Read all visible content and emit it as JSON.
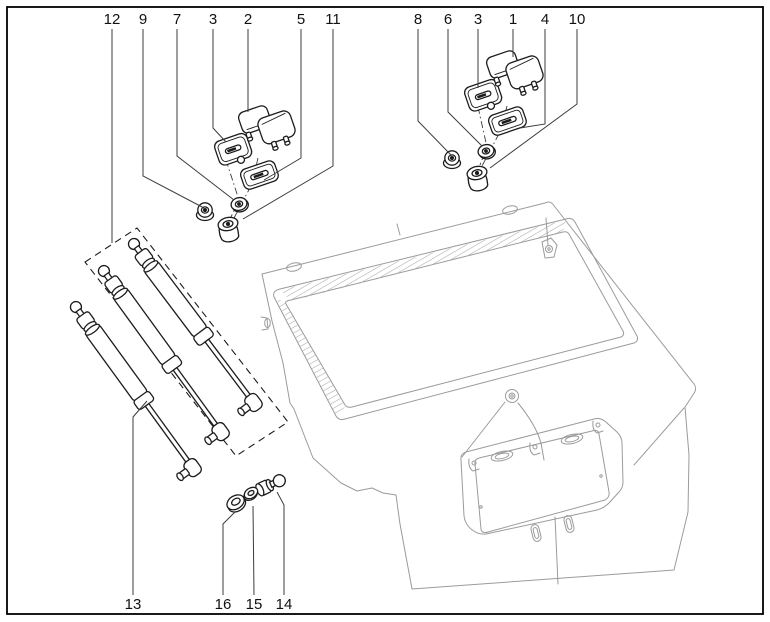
{
  "diagram": {
    "description": "Exploded parts diagram of a vehicle tailgate with gas struts, hinges, gaskets, nuts and grommets",
    "colors": {
      "background": "#ffffff",
      "border": "#000000",
      "part_lines": "#1c1c1c",
      "body_lines": "#9b9b9b",
      "leader_lines": "#3d3d3d",
      "labels": "#111111"
    },
    "callouts": [
      {
        "label": "12",
        "x": 112,
        "y": 24,
        "leader": [
          [
            112,
            29
          ],
          [
            112,
            243
          ]
        ]
      },
      {
        "label": "9",
        "x": 143,
        "y": 24,
        "leader": [
          [
            143,
            29
          ],
          [
            143,
            176
          ],
          [
            204,
            208
          ]
        ]
      },
      {
        "label": "7",
        "x": 177,
        "y": 24,
        "leader": [
          [
            177,
            29
          ],
          [
            177,
            156
          ],
          [
            234,
            200
          ]
        ]
      },
      {
        "label": "3",
        "x": 213,
        "y": 24,
        "leader": [
          [
            213,
            29
          ],
          [
            213,
            128
          ],
          [
            226,
            142
          ]
        ]
      },
      {
        "label": "2",
        "x": 248,
        "y": 24,
        "leader": [
          [
            248,
            29
          ],
          [
            248,
            112
          ]
        ]
      },
      {
        "label": "5",
        "x": 301,
        "y": 24,
        "leader": [
          [
            301,
            29
          ],
          [
            301,
            158
          ],
          [
            264,
            180
          ]
        ]
      },
      {
        "label": "11",
        "x": 333,
        "y": 24,
        "leader": [
          [
            333,
            29
          ],
          [
            333,
            166
          ],
          [
            243,
            219
          ]
        ]
      },
      {
        "label": "8",
        "x": 418,
        "y": 24,
        "leader": [
          [
            418,
            29
          ],
          [
            418,
            121
          ],
          [
            451,
            155
          ]
        ]
      },
      {
        "label": "6",
        "x": 448,
        "y": 24,
        "leader": [
          [
            448,
            29
          ],
          [
            448,
            112
          ],
          [
            482,
            146
          ]
        ]
      },
      {
        "label": "3",
        "x": 478,
        "y": 24,
        "leader": [
          [
            478,
            29
          ],
          [
            478,
            88
          ]
        ]
      },
      {
        "label": "1",
        "x": 513,
        "y": 24,
        "leader": [
          [
            513,
            29
          ],
          [
            513,
            57
          ]
        ]
      },
      {
        "label": "4",
        "x": 545,
        "y": 24,
        "leader": [
          [
            545,
            29
          ],
          [
            545,
            124
          ],
          [
            520,
            128
          ]
        ]
      },
      {
        "label": "10",
        "x": 577,
        "y": 24,
        "leader": [
          [
            577,
            29
          ],
          [
            577,
            104
          ],
          [
            490,
            168
          ]
        ]
      },
      {
        "label": "13",
        "x": 133,
        "y": 609,
        "leader": [
          [
            133,
            595
          ],
          [
            133,
            417
          ],
          [
            147,
            401
          ]
        ]
      },
      {
        "label": "16",
        "x": 223,
        "y": 609,
        "leader": [
          [
            223,
            595
          ],
          [
            223,
            524
          ],
          [
            235,
            512
          ]
        ]
      },
      {
        "label": "15",
        "x": 254,
        "y": 609,
        "leader": [
          [
            254,
            595
          ],
          [
            253,
            506
          ]
        ]
      },
      {
        "label": "14",
        "x": 284,
        "y": 609,
        "leader": [
          [
            284,
            595
          ],
          [
            284,
            505
          ],
          [
            277,
            492
          ]
        ]
      }
    ]
  }
}
